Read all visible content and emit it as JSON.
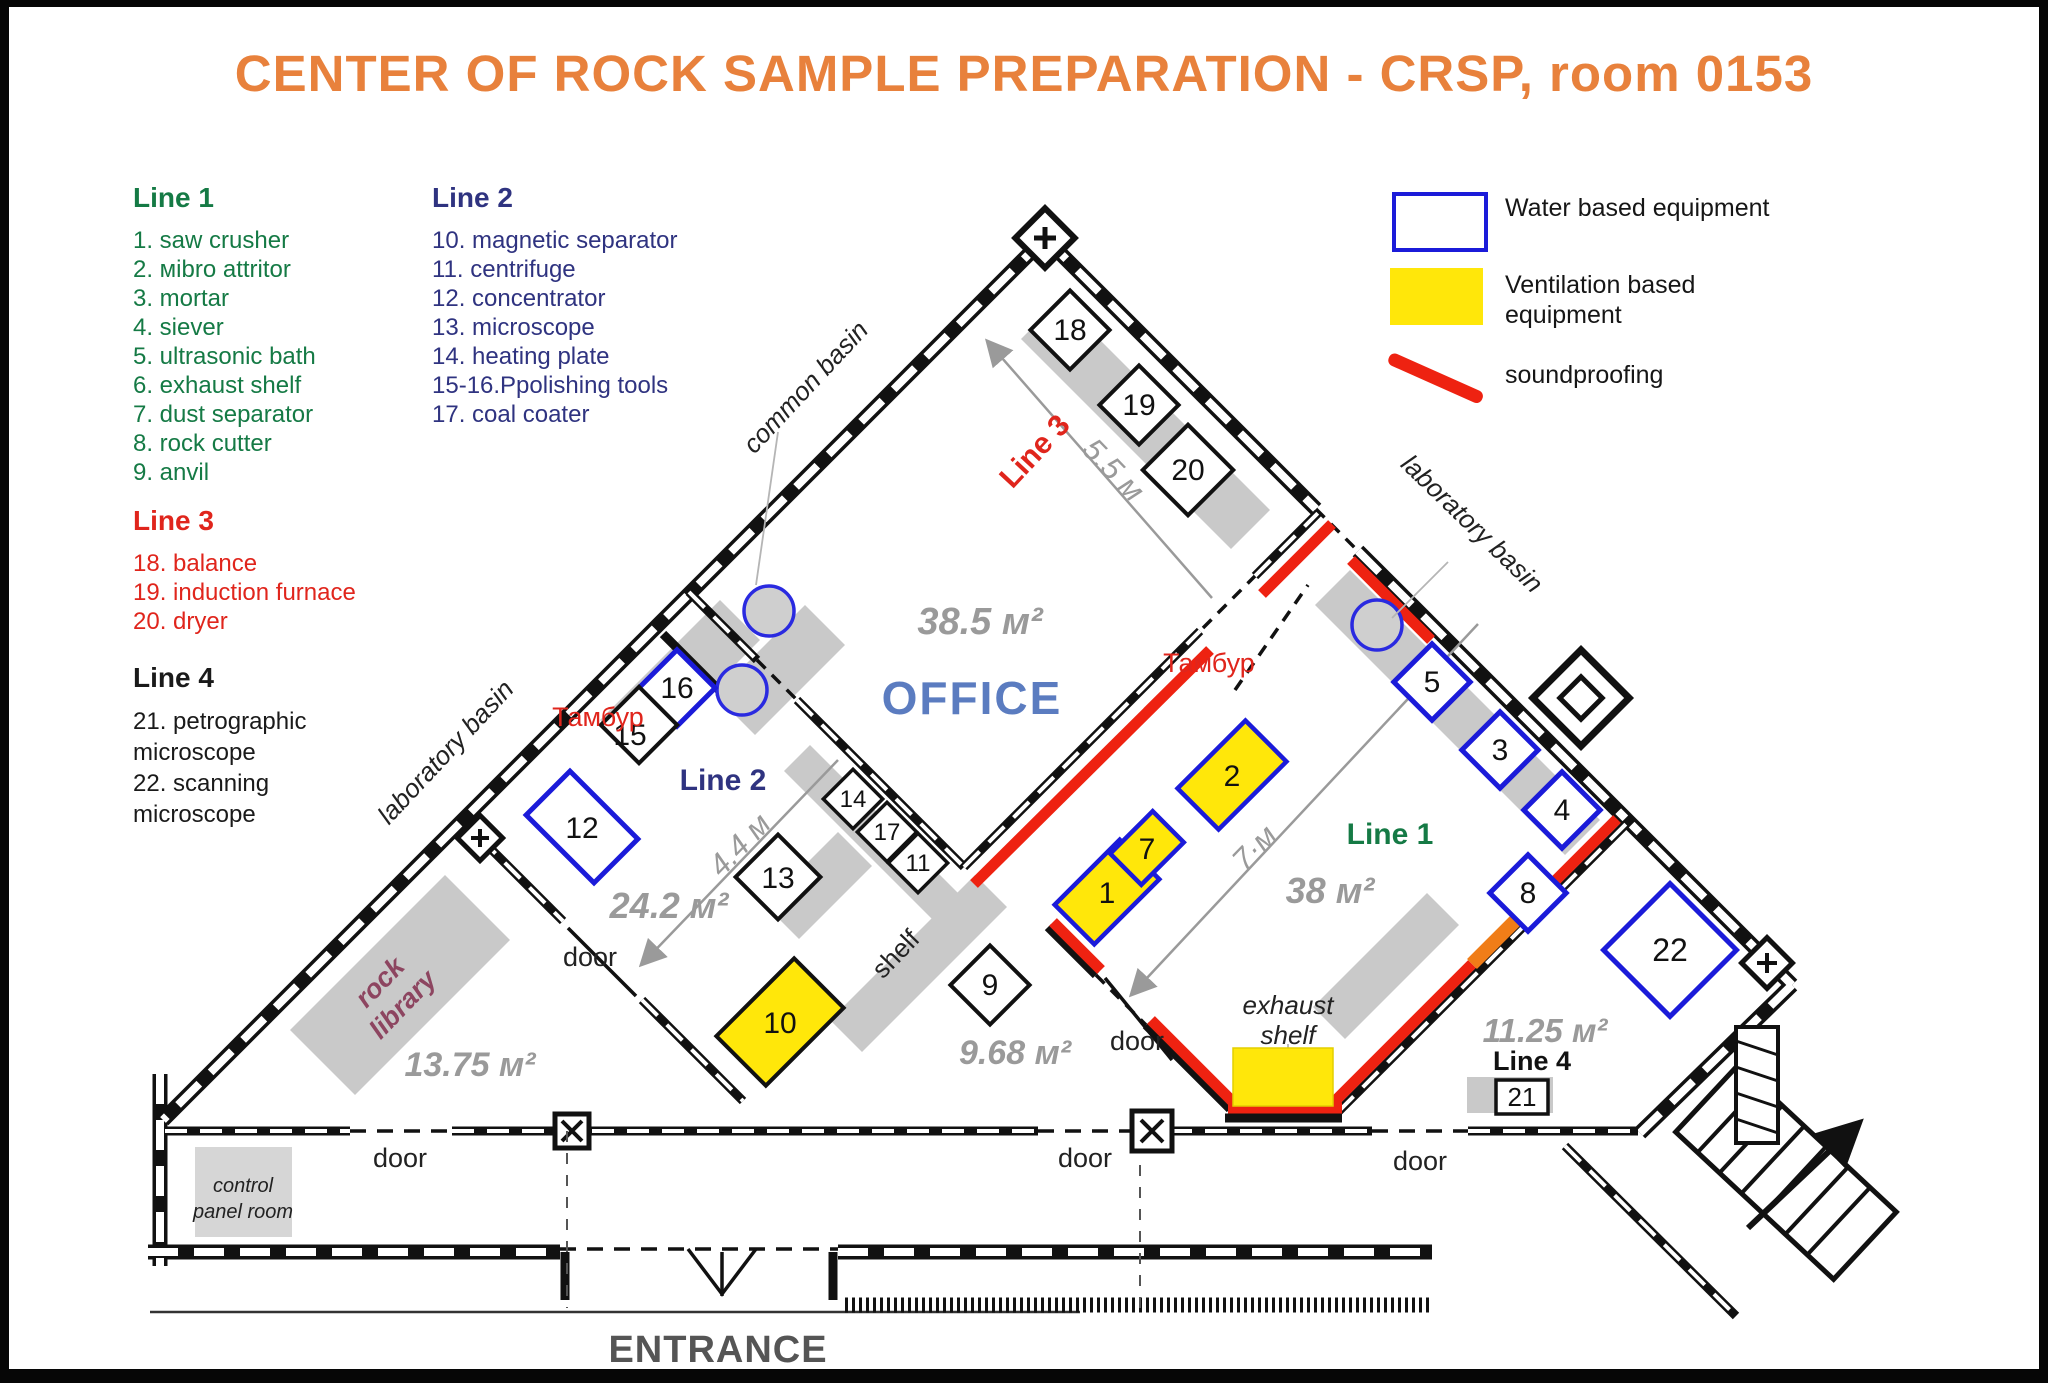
{
  "title": "CENTER OF ROCK SAMPLE PREPARATION - CRSP, room 0153",
  "legend": {
    "line1": {
      "header": "Line 1",
      "items": [
        "1. saw crusher",
        "2. мibro attritor",
        "3. mortar",
        "4. siever",
        "5. ultrasonic bath",
        "6. exhaust shelf",
        "7. dust separator",
        "8. rock cutter",
        "9. anvil"
      ]
    },
    "line2": {
      "header": "Line 2",
      "items": [
        "10. magnetic separator",
        "11. centrifuge",
        "12. concentrator",
        "13. microscope",
        "14. heating plate",
        "15-16.Ppolishing tools",
        "17. coal coater"
      ]
    },
    "line3": {
      "header": "Line 3",
      "items": [
        "18. balance",
        "19. induction furnace",
        "20. dryer"
      ]
    },
    "line4": {
      "header": "Line 4",
      "items": [
        "21. petrographic",
        "microscope",
        "22. scanning",
        "microscope"
      ]
    }
  },
  "equipment_legend": {
    "water": "Water based equipment",
    "ventilation_line1": "Ventilation based",
    "ventilation_line2": "equipment",
    "soundproofing": "soundproofing"
  },
  "plan": {
    "rooms": {
      "office": "OFFICE",
      "office_area": "38.5 м²",
      "line1_area": "38 м²",
      "line2_area": "24.2 м²",
      "rock_area": "13.75 м²",
      "mid_area": "9.68 м²",
      "line4_area": "11.25 м²"
    },
    "lines": {
      "line1": "Line 1",
      "line2": "Line 2",
      "line3": "Line 3",
      "line4": "Line 4"
    },
    "dims": {
      "d55": "5.5 м",
      "d44": "4.4 м",
      "d7": "7·м"
    },
    "labels": {
      "common_basin": "common basin",
      "lab_basin_left": "laboratory basin",
      "lab_basin_right": "laboratory basin",
      "tambur_left": "Тамбур",
      "tambur_right": "Тамбур",
      "rock_library_1": "rock",
      "rock_library_2": "library",
      "control_panel_1": "control",
      "control_panel_2": "panel room",
      "shelf": "shelf",
      "exhaust_shelf_1": "exhaust",
      "exhaust_shelf_2": "shelf",
      "door_room_left": "door",
      "door_corridor_left": "door",
      "door_corridor_mid": "door",
      "door_room_mid": "door",
      "door_corridor_right": "door",
      "entrance": "ENTRANCE"
    },
    "boxes": {
      "b1": "1",
      "b2": "2",
      "b3": "3",
      "b4": "4",
      "b5": "5",
      "b7": "7",
      "b8": "8",
      "b9": "9",
      "b10": "10",
      "b11": "11",
      "b12": "12",
      "b13": "13",
      "b14": "14",
      "b15": "15",
      "b16": "16",
      "b17": "17",
      "b18": "18",
      "b19": "19",
      "b20": "20",
      "b21": "21",
      "b22": "22"
    }
  },
  "colors": {
    "title_orange": "#e8813c",
    "line1_green": "#157a45",
    "line2_navy": "#2f3380",
    "line3_red": "#e0251c",
    "line4_black": "#1a1a1a",
    "office_blue": "#5b7cc0",
    "soundproof_red": "#ee2211",
    "ventilation_yellow": "#ffe70a",
    "orange_wall": "#f07d18",
    "water_blue": "#1b1bd9",
    "dim_gray": "#9a9a9a",
    "rock_library_maroon": "#8d4560"
  }
}
